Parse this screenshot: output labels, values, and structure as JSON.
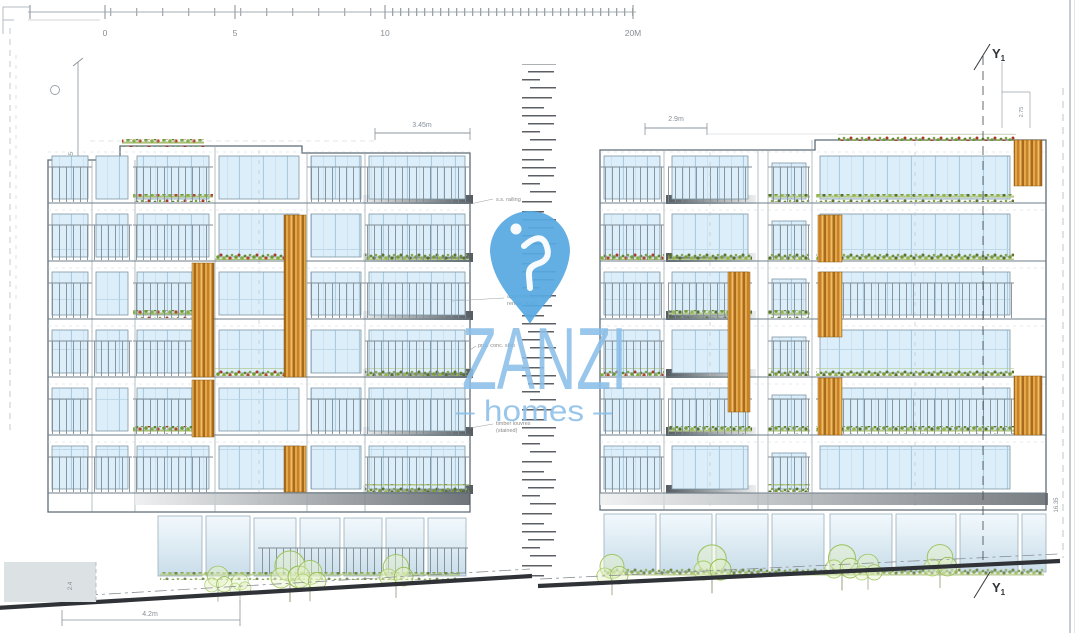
{
  "sheet": {
    "type": "front-elevation-drawing"
  },
  "scalebar": {
    "labels": {
      "l0": "0",
      "l1": "5",
      "l2": "10",
      "l3": "20M"
    }
  },
  "section_markers": {
    "top": {
      "label": "Y",
      "sub": "1"
    },
    "bottom": {
      "label": "Y",
      "sub": "1"
    }
  },
  "dimensions": {
    "left_building_top": "3.45m",
    "right_building_top": "2.9m",
    "bottom_left": "4.2m",
    "left_margin": "20.15",
    "right_margin": "16.35",
    "basement": "2.4",
    "right_upper": "2.75"
  },
  "annotations": {
    "a1": "s.s. railing",
    "a2_line1": "approved textured",
    "a2_line2": "render finish",
    "a3": "proj. conc. slab",
    "a4_line1": "timber louvres",
    "a4_line2": "(stained)"
  },
  "watermark": {
    "brand": "ZANZI",
    "tagline": "homes",
    "tagline_display": "–  homes  –",
    "pin_color": "#57a9e1",
    "text_color": "#8cbfe9"
  },
  "palette": {
    "glass": "#dbeefa",
    "timber": "#d99a38",
    "planting": "#86ad41",
    "slab_dark": "#545b61",
    "ground_line": "#2f3337"
  }
}
